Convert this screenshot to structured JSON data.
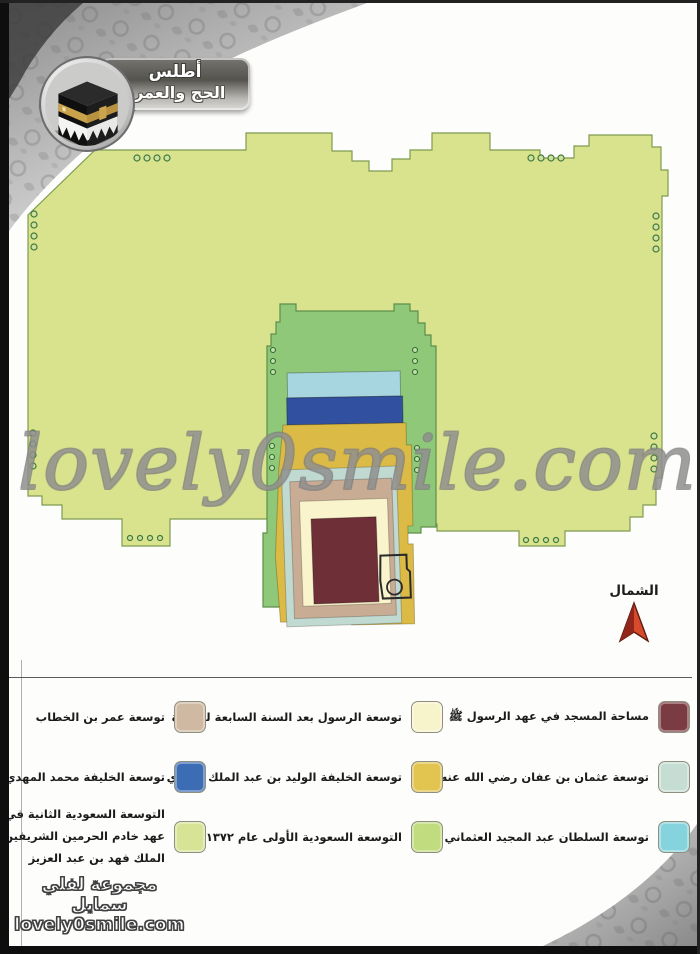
{
  "header": {
    "title_line1": "أطلس",
    "title_line2": "الحج والعمرة",
    "logo": "kaaba-icon"
  },
  "watermark": {
    "text": "lovely0smile.com"
  },
  "north": {
    "label": "الشمال",
    "arrow_color": "#d84a2b",
    "arrow_dark": "#93261a"
  },
  "map": {
    "colors": {
      "fahd_second_saudi": "#d9e28c",
      "first_saudi": "#8fc879",
      "ottoman_abdulmajid": "#a7d6e1",
      "abbasid_mahdi": "#31509f",
      "umayyad_walid": "#dcba46",
      "uthman": "#c0dad2",
      "umar": "#c9ac94",
      "prophet_after_7ah": "#f9f4cc",
      "prophet_mosque": "#6f2f37"
    }
  },
  "legend": {
    "items": [
      {
        "label": "مساحة المسجد في عهد الرسول ﷺ",
        "color": "#7b3b42"
      },
      {
        "label": "توسعة الرسول بعد السنة السابعة للهجرة",
        "color": "#f7f3cb"
      },
      {
        "label": "توسعة عمر بن الخطاب",
        "color": "#cfb9a3"
      },
      {
        "label": "توسعة عثمان بن عفان رضي الله عنه",
        "color": "#c6ddd3"
      },
      {
        "label": "توسعة الخليفة الوليد بن عبد الملك الأموي",
        "color": "#e2c450"
      },
      {
        "label": "توسعة الخليفة محمد المهدي العباسي",
        "color": "#3c6cb4"
      },
      {
        "label": "توسعة السلطان عبد المجيد العثماني",
        "color": "#84d3dd"
      },
      {
        "label": "التوسعة السعودية الأولى عام ١٣٧٢ هـ",
        "color": "#c0dc7e"
      },
      {
        "label": "التوسعة السعودية الثانية في عهد خادم الحرمين الشريفين الملك فهد بن عبد العزيز",
        "color": "#d7e495"
      }
    ]
  },
  "footer": {
    "line1": "مجموعة لفلي سمايل",
    "line2": "lovely0smile.com"
  }
}
